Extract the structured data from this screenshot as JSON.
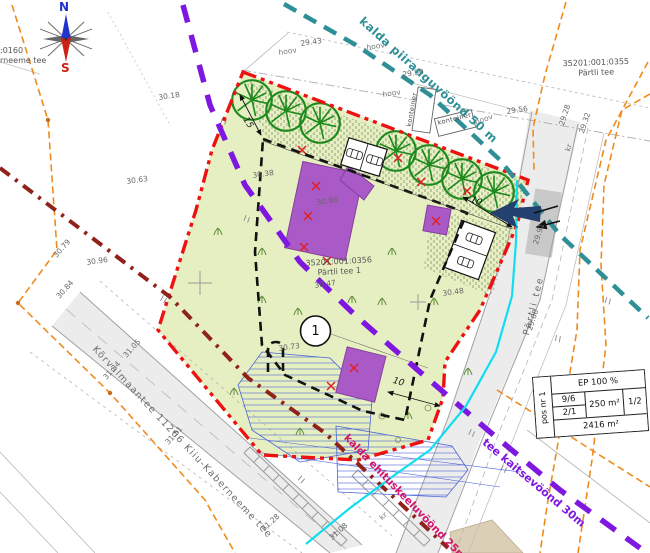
{
  "drawing": {
    "compass": {
      "north": "N",
      "south": "S"
    },
    "pos_marker": "1",
    "parcels": {
      "site": {
        "id": "35201:001:0356",
        "name": "Pärtli tee 1"
      },
      "north": {
        "id": "35201:001:0355",
        "name": "Pärtli tee"
      },
      "west": {
        "id_fragment": ":0160",
        "name_fragment": "rneeme  tee"
      }
    },
    "roads": {
      "main": "Kõrvalmaantee 11266 Kiiu-Kaberneeme tee",
      "partli": "Pärtli tee"
    },
    "zones": {
      "shore_limit": {
        "label": "kalda piiranguvöönd 50 m",
        "color": "#2f8f96"
      },
      "road_protection": {
        "label": "tee kaitsevöönd 30m",
        "color": "#7e17e0"
      },
      "building_exclusion": {
        "label": "kalda ehituskeeluvöönd 25m",
        "color": "#d4146e"
      }
    },
    "info_table": {
      "pos": "pos nr 1",
      "top": "EP 100 %",
      "cell_96": "9/6",
      "cell_21": "2/1",
      "cell_area": "250 m²",
      "cell_12": "1/2",
      "bottom": "2416 m²"
    },
    "colors": {
      "site_boundary_red": "#ee1111",
      "building_purple": "#aa5ac6",
      "site_green": "#e6efc1",
      "cadastral_orange": "#ef8b1d",
      "water_cyan": "#12dcf0",
      "envelope_black": "#111111",
      "maroon_line": "#8f2219"
    },
    "map_labels": [
      {
        "t": "29.43",
        "x": 300,
        "y": 40,
        "r": -8,
        "c": "sh"
      },
      {
        "t": "29.50",
        "x": 402,
        "y": 71,
        "r": -8,
        "c": "sh"
      },
      {
        "t": "29.56",
        "x": 506,
        "y": 108,
        "r": -8,
        "c": "sh"
      },
      {
        "t": "30.18",
        "x": 158,
        "y": 94,
        "r": -8,
        "c": "sh"
      },
      {
        "t": "30.63",
        "x": 126,
        "y": 178,
        "r": -8,
        "c": "sh"
      },
      {
        "t": "30.96",
        "x": 86,
        "y": 259,
        "r": -8,
        "c": "sh"
      },
      {
        "t": "30.38",
        "x": 252,
        "y": 172,
        "r": -8,
        "c": "sh"
      },
      {
        "t": "30.86",
        "x": 316,
        "y": 199,
        "r": -8,
        "c": "sh"
      },
      {
        "t": "30.73",
        "x": 278,
        "y": 345,
        "r": -8,
        "c": "sh"
      },
      {
        "t": "30.47",
        "x": 314,
        "y": 282,
        "r": -8,
        "c": "sh"
      },
      {
        "t": "30.48",
        "x": 442,
        "y": 290,
        "r": -8,
        "c": "sh"
      },
      {
        "t": "30.79",
        "x": 52,
        "y": 254,
        "r": -48,
        "c": "sh"
      },
      {
        "t": "30.84",
        "x": 55,
        "y": 295,
        "r": -48,
        "c": "sh"
      },
      {
        "t": "31.05",
        "x": 122,
        "y": 354,
        "r": -48,
        "c": "sh"
      },
      {
        "t": "31.34",
        "x": 102,
        "y": 376,
        "r": -48,
        "c": "sh"
      },
      {
        "t": "31.51",
        "x": 164,
        "y": 441,
        "r": -48,
        "c": "sh"
      },
      {
        "t": "31.28",
        "x": 260,
        "y": 527,
        "r": -42,
        "c": "sh"
      },
      {
        "t": "31.08",
        "x": 328,
        "y": 536,
        "r": -42,
        "c": "sh"
      },
      {
        "t": "29.28",
        "x": 558,
        "y": 124,
        "r": -72,
        "c": "sh"
      },
      {
        "t": "29.32",
        "x": 578,
        "y": 132,
        "r": -72,
        "c": "sh"
      },
      {
        "t": "29.91",
        "x": 532,
        "y": 243,
        "r": -72,
        "c": "sh"
      },
      {
        "t": "29.68",
        "x": 526,
        "y": 329,
        "r": -72,
        "c": "sh"
      },
      {
        "t": "hoov",
        "x": 278,
        "y": 49,
        "r": -8,
        "c": "hv"
      },
      {
        "t": "hoov",
        "x": 366,
        "y": 44,
        "r": -8,
        "c": "hv"
      },
      {
        "t": "hoov",
        "x": 382,
        "y": 91,
        "r": -8,
        "c": "hv"
      },
      {
        "t": "hoov",
        "x": 474,
        "y": 119,
        "r": -20,
        "c": "hv"
      },
      {
        "t": "kr",
        "x": 564,
        "y": 150,
        "r": -72,
        "c": "hv"
      },
      {
        "t": "kr",
        "x": 378,
        "y": 516,
        "r": -42,
        "c": "hv"
      },
      {
        "t": "konteiner",
        "x": 406,
        "y": 126,
        "r": -80,
        "c": "kt"
      },
      {
        "t": "konteiner",
        "x": 437,
        "y": 120,
        "r": -14,
        "c": "kt"
      },
      {
        "t": "15",
        "x": 248,
        "y": 116,
        "r": 58,
        "c": "dm"
      },
      {
        "t": "10",
        "x": 472,
        "y": 196,
        "r": 21,
        "c": "dm"
      },
      {
        "t": "10",
        "x": 394,
        "y": 377,
        "r": 16,
        "c": "dm"
      }
    ]
  }
}
